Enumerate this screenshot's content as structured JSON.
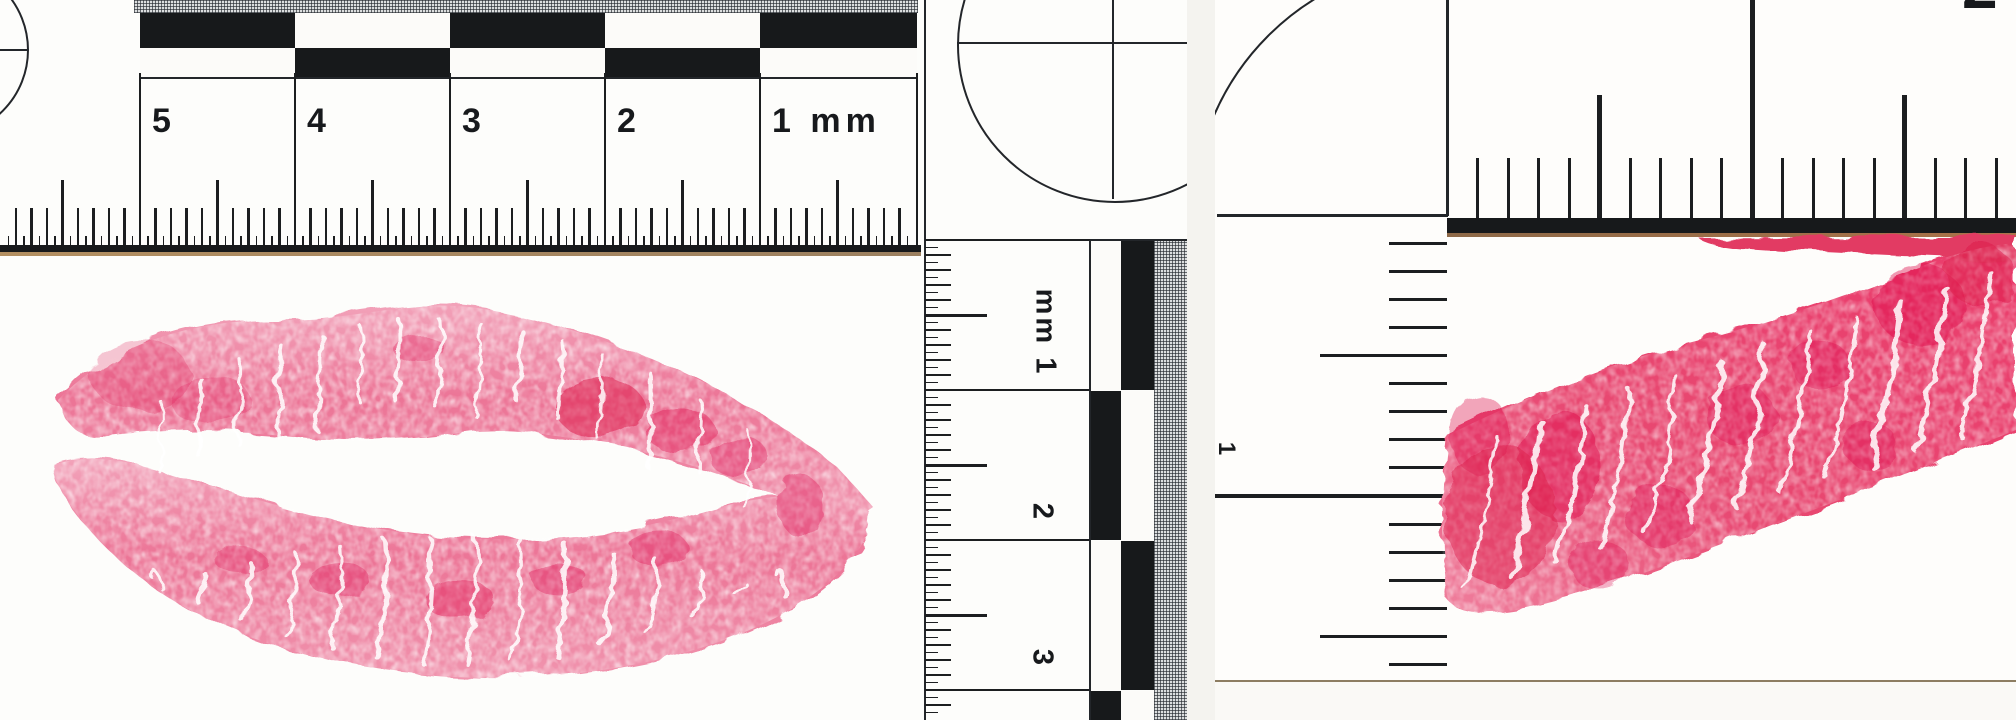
{
  "meta": {
    "title": "Scanned forensic lip-print evidence with photomacrographic scales",
    "canvas_width": 2016,
    "canvas_height": 720
  },
  "colors": {
    "ruler_black": "#1c1e20",
    "paper_white": "#fdfdfb",
    "scanner_background": "#f2f1ee",
    "baseline_shadow_brown": "#8a6a45",
    "lip_pink_mid": "#ec7496",
    "lip_pink_light": "#f6c3d2",
    "lip_crimson_deep": "#dc0f45",
    "right_lip_pink": "#e84871"
  },
  "left_photo": {
    "description": "Full lipstick kiss print (upper and lower lip) below a millimetre scale",
    "top_ruler": {
      "labels": [
        "5",
        "4",
        "3",
        "2",
        "1 mm"
      ]
    },
    "side_ruler": {
      "labels": [
        "mm 1",
        "2",
        "3"
      ]
    },
    "targets": [
      "partial circle crosshair at left edge",
      "circle crosshair above side scale"
    ]
  },
  "right_photo": {
    "description": "Enlarged partial lip print as diagonal band inside an L-shaped scale",
    "top_ruler": {
      "label": "2"
    },
    "side_ruler": {
      "label": "1"
    },
    "targets": [
      "quarter circle arc at scale corner"
    ]
  }
}
